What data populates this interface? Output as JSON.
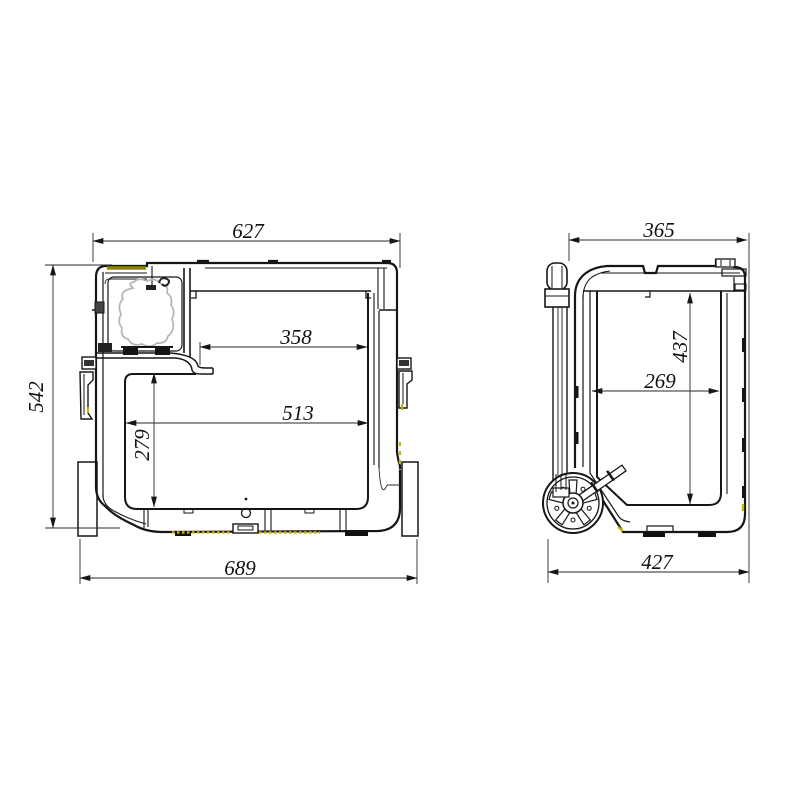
{
  "front_view": {
    "top_width": "627",
    "overall_height": "542",
    "inner_top_width": "358",
    "inner_width": "513",
    "inner_depth_height": "279",
    "base_width": "689"
  },
  "side_view": {
    "top_depth": "365",
    "inner_height": "437",
    "inner_depth": "269",
    "base_depth": "427"
  },
  "colors": {
    "line": "#161616",
    "accent_olive": "#8f8600",
    "accent_yellow": "#c9b400",
    "compressor_gray": "#b5b5b5",
    "background": "#ffffff"
  }
}
